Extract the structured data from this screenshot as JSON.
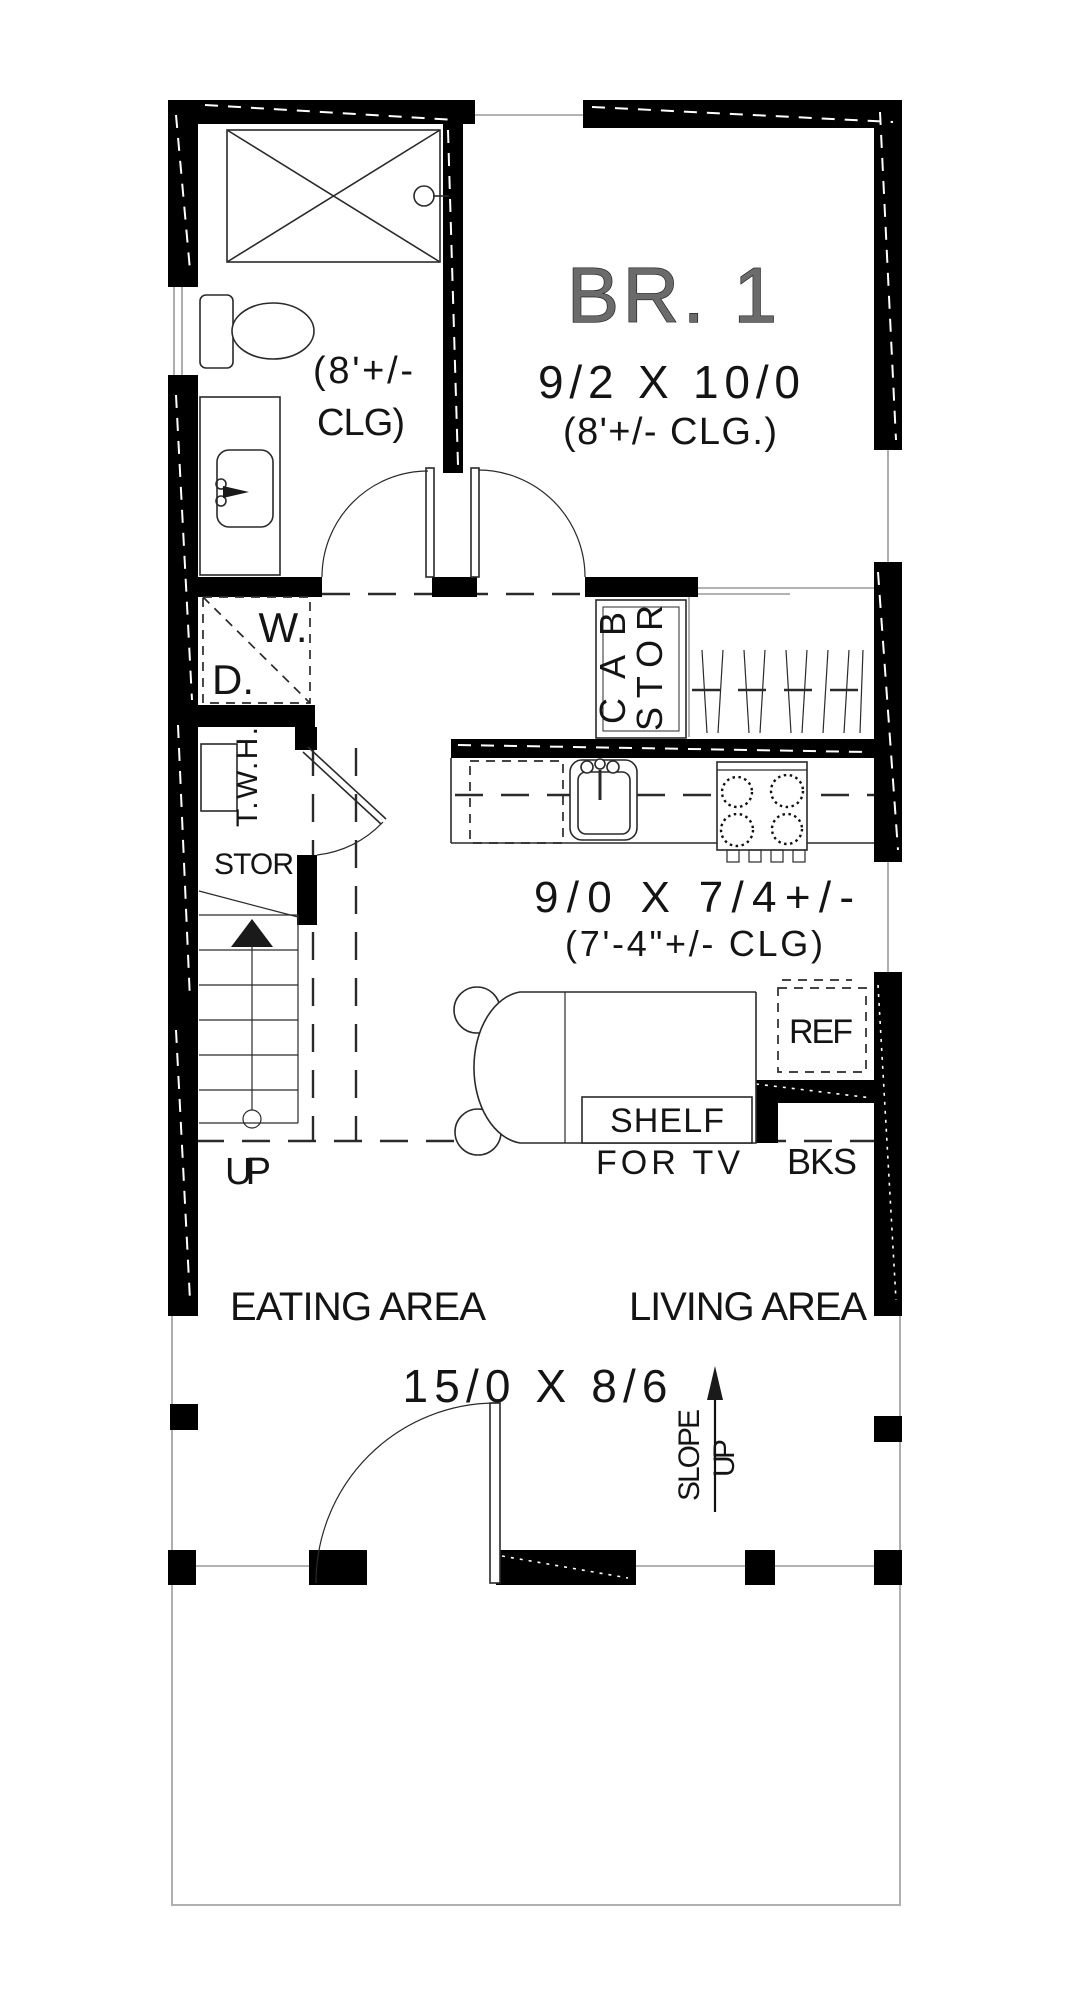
{
  "colors": {
    "walls": "#000000",
    "text": "#141414",
    "thin_lines": "#9a9a9a"
  },
  "labels": {
    "br1_name": "BR. 1",
    "br1_dim": "9/2 X 10/0",
    "br1_clg": "(8'+/- CLG.)",
    "bath_clg_1": "(8'+/-",
    "bath_clg_2": "CLG)",
    "washer": "W.",
    "dryer": "D.",
    "cab": "CAB",
    "cab_stor": "STOR",
    "twh": "T.W.H.",
    "stor": "STOR",
    "kitchen_dim": "9/0 X 7/4+/-",
    "kitchen_clg": "(7'-4\"+/- CLG)",
    "ref": "REF",
    "shelf": "SHELF",
    "for_tv": "FOR TV",
    "bks": "BKS",
    "up": "UP",
    "eating": "EATING AREA",
    "living": "LIVING AREA",
    "main_dim": "15/0 X 8/6",
    "slope": "SLOPE",
    "slope_up": "UP"
  }
}
